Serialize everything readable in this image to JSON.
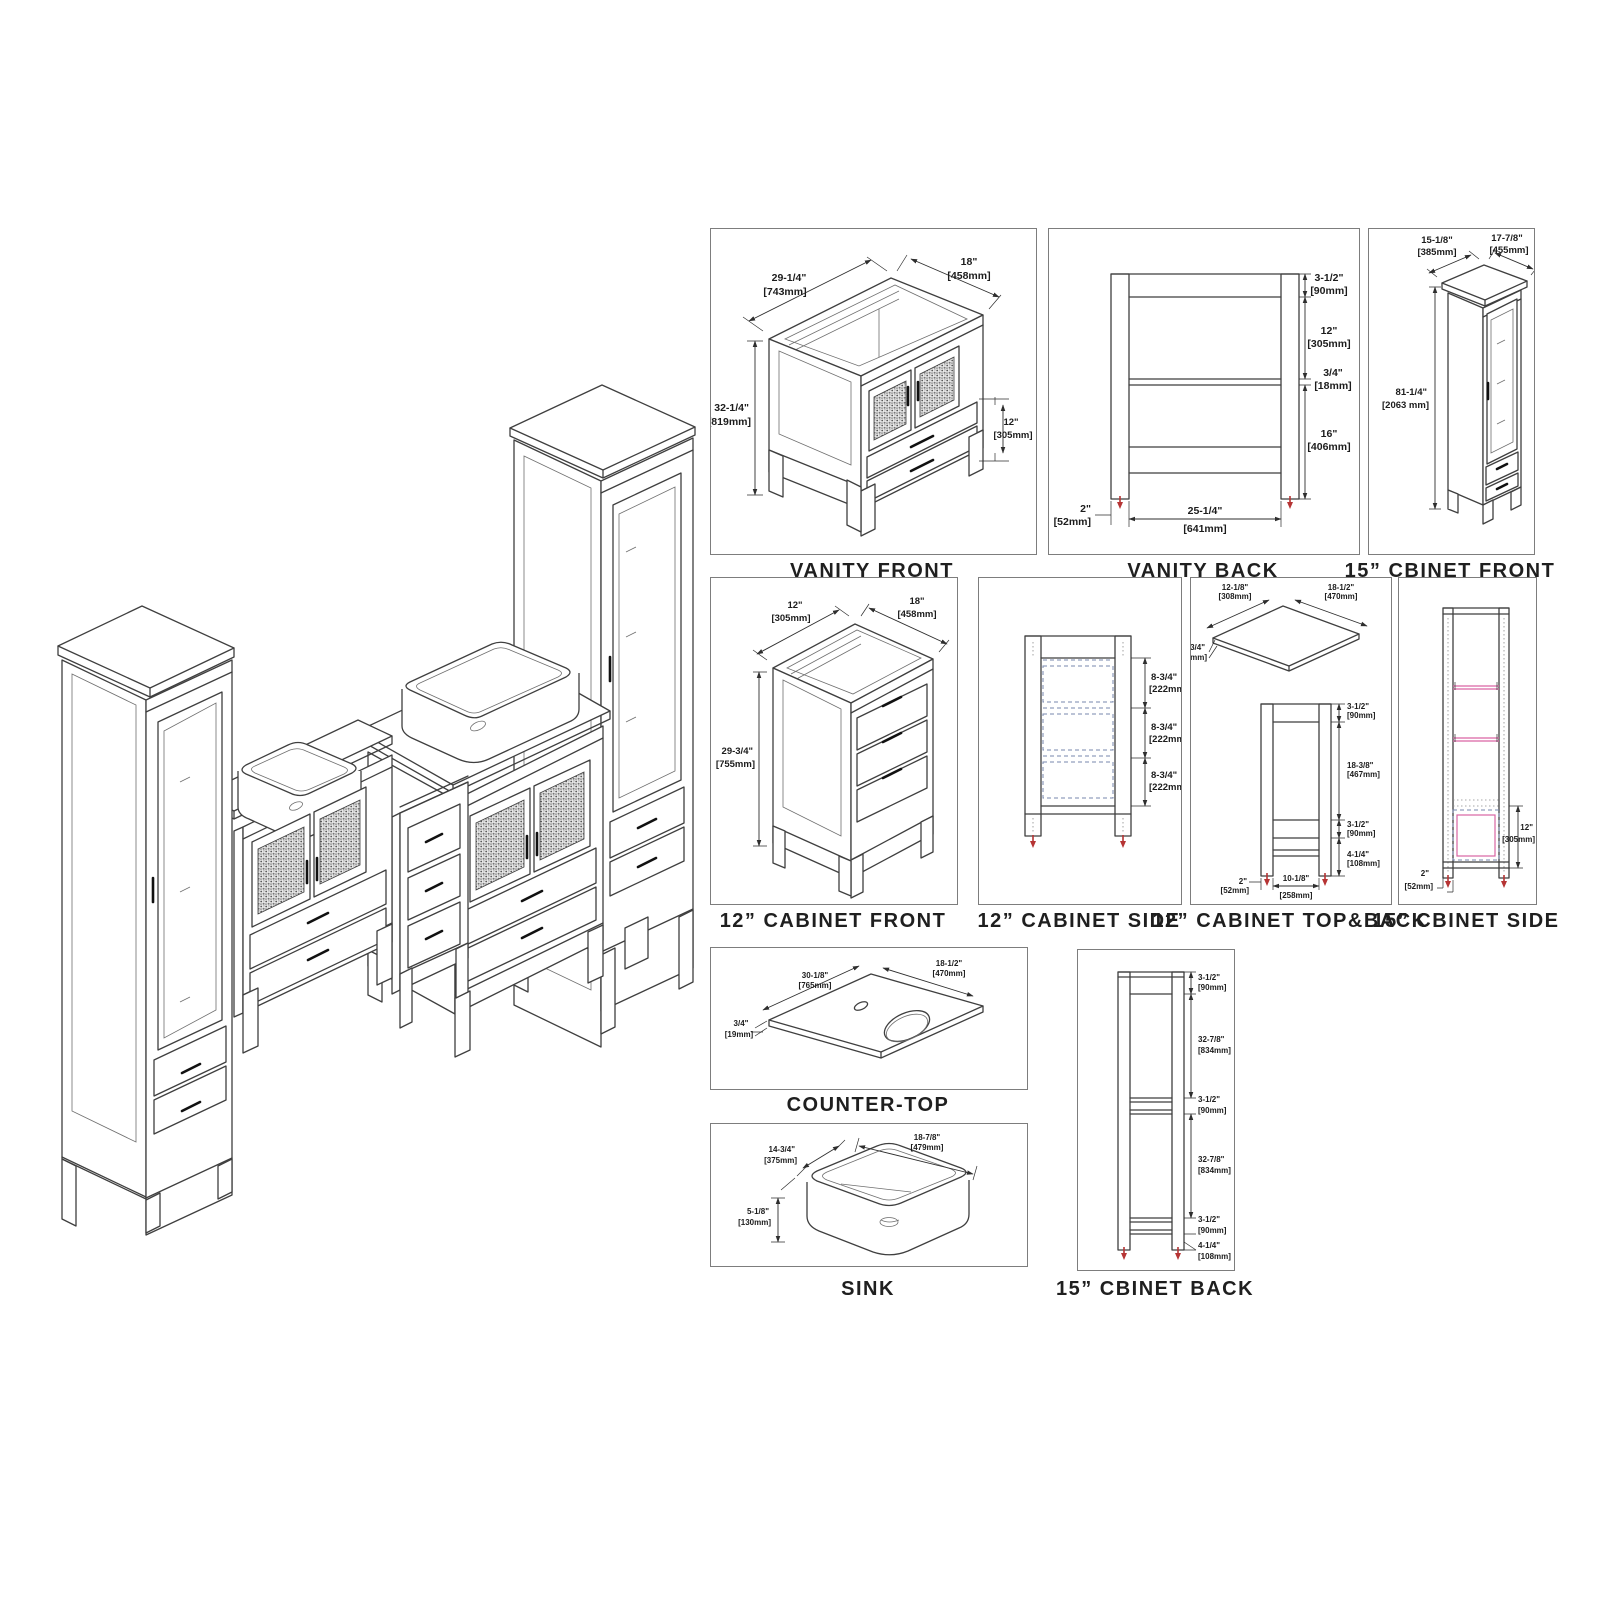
{
  "colors": {
    "line": "#3f3f3f",
    "foot_arrow_red": "#b63434",
    "shelf_pink": "#d964a4",
    "drawer_dashed_blue": "#7787ad",
    "background": "#ffffff"
  },
  "panels": {
    "vanity_front": {
      "title": "VANITY FRONT",
      "dims": [
        {
          "in": "29-1/4\"",
          "mm": "[743mm]"
        },
        {
          "in": "18\"",
          "mm": "[458mm]"
        },
        {
          "in": "32-1/4\"",
          "mm": "[819mm]"
        },
        {
          "in": "12\"",
          "mm": "[305mm]"
        }
      ]
    },
    "vanity_back": {
      "title": "VANITY BACK",
      "dims": [
        {
          "in": "3-1/2\"",
          "mm": "[90mm]"
        },
        {
          "in": "12\"",
          "mm": "[305mm]"
        },
        {
          "in": "3/4\"",
          "mm": "[18mm]"
        },
        {
          "in": "16\"",
          "mm": "[406mm]"
        },
        {
          "in": "2\"",
          "mm": "[52mm]"
        },
        {
          "in": "25-1/4\"",
          "mm": "[641mm]"
        }
      ]
    },
    "cbinet15_front": {
      "title": "15” CBINET FRONT",
      "dims": [
        {
          "in": "15-1/8\"",
          "mm": "[385mm]"
        },
        {
          "in": "17-7/8\"",
          "mm": "[455mm]"
        },
        {
          "in": "81-1/4\"",
          "mm": "[2063 mm]"
        }
      ]
    },
    "cabinet12_front": {
      "title": "12” CABINET FRONT",
      "dims": [
        {
          "in": "12\"",
          "mm": "[305mm]"
        },
        {
          "in": "18\"",
          "mm": "[458mm]"
        },
        {
          "in": "29-3/4\"",
          "mm": "[755mm]"
        }
      ]
    },
    "cabinet12_side": {
      "title": "12” CABINET SIDE",
      "dims": [
        {
          "in": "8-3/4\"",
          "mm": "[222mm]"
        },
        {
          "in": "8-3/4\"",
          "mm": "[222mm]"
        },
        {
          "in": "8-3/4\"",
          "mm": "[222mm]"
        }
      ]
    },
    "cabinet12_topback": {
      "title": "12” CABINET TOP&BACK",
      "dims": [
        {
          "in": "12-1/8\"",
          "mm": "[308mm]"
        },
        {
          "in": "18-1/2\"",
          "mm": "[470mm]"
        },
        {
          "in": "3/4\"",
          "mm": "[19mm]"
        },
        {
          "in": "3-1/2\"",
          "mm": "[90mm]"
        },
        {
          "in": "18-3/8\"",
          "mm": "[467mm]"
        },
        {
          "in": "3-1/2\"",
          "mm": "[90mm]"
        },
        {
          "in": "4-1/4\"",
          "mm": "[108mm]"
        },
        {
          "in": "2\"",
          "mm": "[52mm]"
        },
        {
          "in": "10-1/8\"",
          "mm": "[258mm]"
        }
      ]
    },
    "cbinet15_side": {
      "title": "15” CBINET SIDE",
      "dims": [
        {
          "in": "12\"",
          "mm": "[305mm]"
        },
        {
          "in": "2\"",
          "mm": "[52mm]"
        }
      ]
    },
    "countertop": {
      "title": "COUNTER-TOP",
      "dims": [
        {
          "in": "30-1/8\"",
          "mm": "[765mm]"
        },
        {
          "in": "18-1/2\"",
          "mm": "[470mm]"
        },
        {
          "in": "3/4\"",
          "mm": "[19mm]"
        }
      ]
    },
    "sink": {
      "title": "SINK",
      "dims": [
        {
          "in": "18-7/8\"",
          "mm": "[479mm]"
        },
        {
          "in": "14-3/4\"",
          "mm": "[375mm]"
        },
        {
          "in": "5-1/8\"",
          "mm": "[130mm]"
        }
      ]
    },
    "cbinet15_back": {
      "title": "15” CBINET BACK",
      "dims": [
        {
          "in": "3-1/2\"",
          "mm": "[90mm]"
        },
        {
          "in": "32-7/8\"",
          "mm": "[834mm]"
        },
        {
          "in": "3-1/2\"",
          "mm": "[90mm]"
        },
        {
          "in": "32-7/8\"",
          "mm": "[834mm]"
        },
        {
          "in": "3-1/2\"",
          "mm": "[90mm]"
        },
        {
          "in": "4-1/4\"",
          "mm": "[108mm]"
        }
      ]
    }
  }
}
